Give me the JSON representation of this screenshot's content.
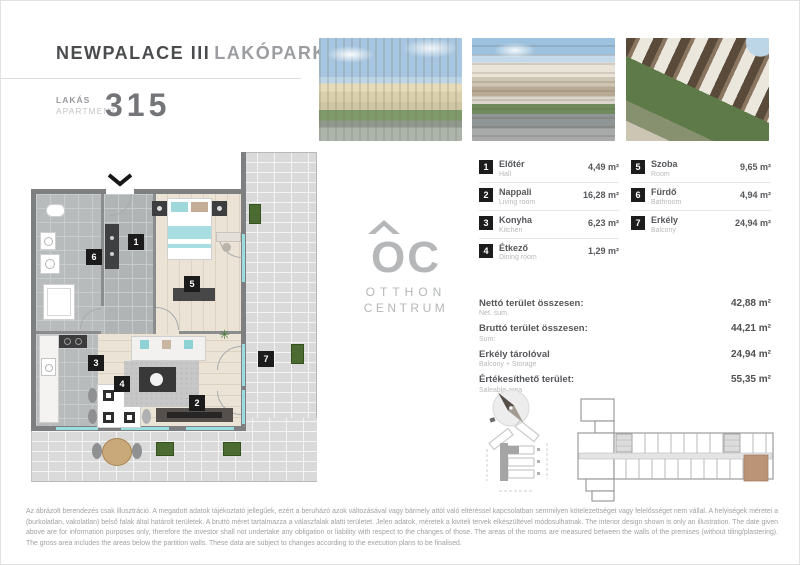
{
  "header": {
    "project": "NEWPALACE",
    "phase": "III",
    "suffix": "LAKÓPARK",
    "unit_label_hu": "LAKÁS",
    "unit_label_en": "APARTMENT",
    "unit_number": "315"
  },
  "photos": [
    {
      "name": "render-residential-complex-panorama"
    },
    {
      "name": "render-street-facade"
    },
    {
      "name": "render-courtyard-balconies"
    }
  ],
  "rooms": [
    {
      "num": "1",
      "name_hu": "Előtér",
      "name_en": "Hall",
      "area": "4,49 m²"
    },
    {
      "num": "2",
      "name_hu": "Nappali",
      "name_en": "Living room",
      "area": "16,28 m²"
    },
    {
      "num": "3",
      "name_hu": "Konyha",
      "name_en": "Kitchen",
      "area": "6,23 m²"
    },
    {
      "num": "4",
      "name_hu": "Étkező",
      "name_en": "Dining room",
      "area": "1,29 m²"
    },
    {
      "num": "5",
      "name_hu": "Szoba",
      "name_en": "Room",
      "area": "9,65 m²"
    },
    {
      "num": "6",
      "name_hu": "Fürdő",
      "name_en": "Bathroom",
      "area": "4,94 m²"
    },
    {
      "num": "7",
      "name_hu": "Erkély",
      "name_en": "Balcony",
      "area": "24,94 m²"
    }
  ],
  "totals": [
    {
      "label_hu": "Nettó terület összesen:",
      "label_en": "Net. sum.",
      "value": "42,88 m²"
    },
    {
      "label_hu": "Bruttó terület összesen:",
      "label_en": "Sum:",
      "value": "44,21 m²"
    },
    {
      "label_hu": "Erkély tárolóval",
      "label_en": "Balcony + Storage",
      "value": "24,94 m²"
    },
    {
      "label_hu": "Értékesíthető terület:",
      "label_en": "Saleable area",
      "value": "55,35 m²"
    }
  ],
  "logo": {
    "monogram": "OC",
    "word1": "OTTHON",
    "word2": "CENTRUM"
  },
  "disclaimer": "Az ábrázolt berendezés csak illusztráció. A megadott adatok tájékoztató jellegűek, ezért a beruházó azok változásával vagy bármely attól való eltéréssel kapcsolatban semmilyen kötelezettséget vagy felelősséget nem vállal. A helyiségek méretei a (burkolatlan, vakolatlan) belső falak által határolt területek. A bruttó méret tartalmazza a válaszfalak alatti területet. Jelen adatok, méretek a kiviteli tervek elkészültével módosulhatnak. The interior design shown is only an illustration. The date given above are for information purposes only, therefore the investor shall not undertake any obligation or liability with respect to the changes of those. The areas of the rooms are measured between the walls of the premises (without tiling/plastering). The gross area includes the areas below the partition walls. These data are subject to changes according to the execution plans to be finalised.",
  "colors": {
    "text_dark": "#4b4c4e",
    "text_light": "#b7b9bc",
    "badge_black": "#1b1b1b",
    "wall_gray": "#7d7f81",
    "floor_wood": "#ece3d7",
    "floor_tile": "#b8bbbc",
    "paver_gray": "#dadada",
    "window_teal": "#9adde0",
    "planter_green": "#4b6b33",
    "unit_highlight": "#bb9377",
    "logo_gray": "#b5b7b9"
  }
}
